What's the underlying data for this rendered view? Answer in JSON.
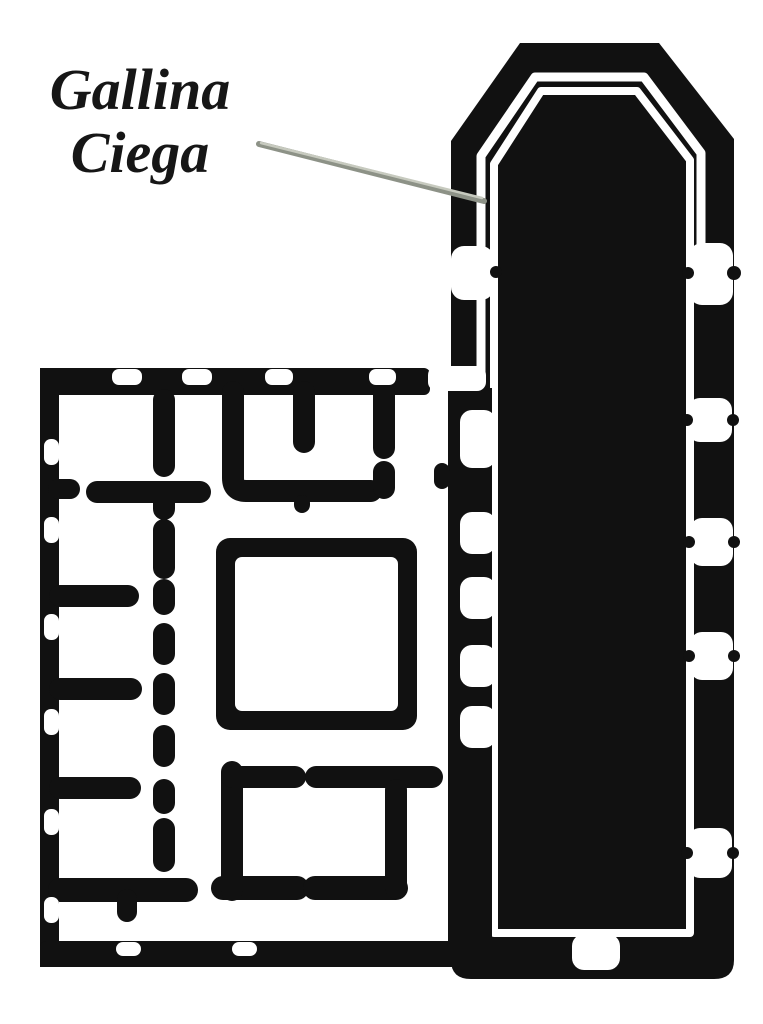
{
  "annotation": {
    "line1": "Gallina",
    "line2": "Ciega",
    "label": "Gallina Ciega"
  },
  "colors": {
    "ink": "#111111",
    "paper": "#ffffff",
    "leader": "#8d9287",
    "leader_highlight": "#c7cabf"
  }
}
